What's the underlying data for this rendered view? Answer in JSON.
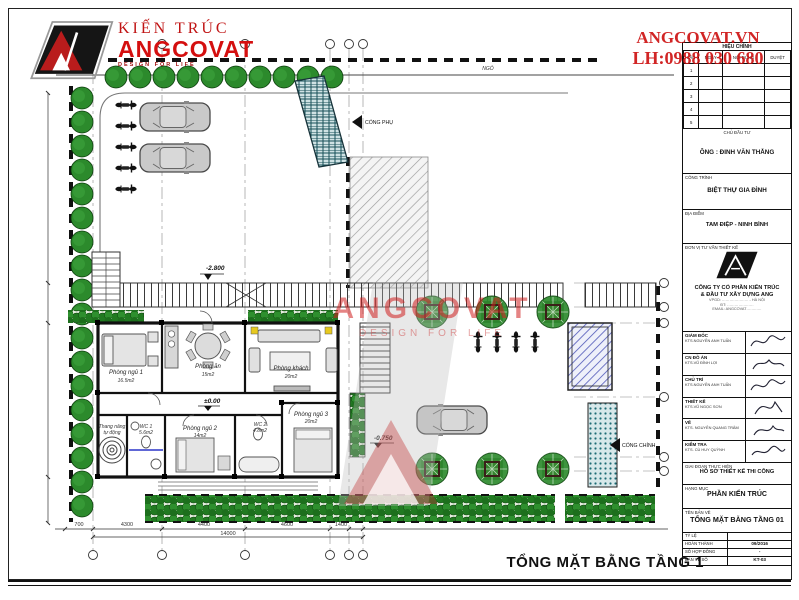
{
  "branding": {
    "logo_top_text": "KIẾN TRÚC",
    "logo_name": "ANGCOVAT",
    "logo_tagline": "DESIGN FOR LIFE",
    "site": "ANGCOVAT.VN",
    "phone": "LH:0988 030 680",
    "watermark_name": "ANGCOVAT",
    "watermark_tagline": "DESIGN FOR LIFE",
    "accent_red": "#d40f0f"
  },
  "revision": {
    "title": "HIỆU CHỈNH",
    "columns": [
      "LẦN",
      "NGÀY",
      "NỘI DUNG",
      "DUYỆT"
    ],
    "row_numbers": [
      "1",
      "2",
      "3",
      "4",
      "5"
    ]
  },
  "title_block": {
    "investor": {
      "label": "CHỦ ĐẦU TƯ",
      "value": "ÔNG : ĐINH VĂN THẮNG"
    },
    "project": {
      "label": "CÔNG TRÌNH",
      "value": "BIỆT THỰ GIA ĐÌNH"
    },
    "location": {
      "label": "ĐỊA ĐIỂM",
      "value": "TAM ĐIỆP - NINH BÌNH"
    },
    "consultant": {
      "label": "ĐƠN VỊ TƯ VẤN THIẾT KẾ",
      "company_line1": "CÔNG TY CỔ PHẦN KIẾN TRÚC",
      "company_line2": "& ĐẦU TƯ XÂY DỰNG ANG",
      "contact1": "VPGD: ………………… - HÀ NỘI",
      "contact2": "ĐT: …………………",
      "contact3": "EMAIL: ANGCOVAT…………"
    },
    "signatures": [
      {
        "role": "GIÁM ĐỐC",
        "name": "KTS.NGUYỄN ANH TUẤN"
      },
      {
        "role": "CN ĐỒ ÁN",
        "name": "KTS.VŨ ĐÌNH LỢI"
      },
      {
        "role": "CHỦ TRÌ",
        "name": "KTS.NGUYỄN ANH TUẤN"
      },
      {
        "role": "THIẾT KẾ",
        "name": "KTS.VŨ NGỌC SƠN"
      },
      {
        "role": "VẼ",
        "name": "KTS. NGUYỄN QUANG TRÂM"
      },
      {
        "role": "KIỂM TRA",
        "name": "KTS. CÙ HUY QUỲNH"
      }
    ],
    "stage": {
      "label": "GIAI ĐOẠN THỰC HIỆN",
      "value": "HỒ SƠ THIẾT KẾ THI CÔNG"
    },
    "category": {
      "label": "HẠNG MỤC",
      "value": "PHẦN KIẾN TRÚC"
    },
    "sheet": {
      "label": "TÊN BẢN VẼ",
      "value": "TỔNG MẶT BẰNG TẦNG 01"
    },
    "meta": [
      {
        "label": "TỶ LỆ",
        "value": ""
      },
      {
        "label": "HOÀN THÀNH",
        "value": "09/2016"
      },
      {
        "label": "SỐ HỢP ĐỒNG",
        "value": "-"
      },
      {
        "label": "BẢN VẼ SỐ",
        "value": "KT-03"
      }
    ]
  },
  "plan": {
    "drawing_title": "TỔNG MẶT BẰNG TẦNG 1",
    "road": "NGỎ",
    "side_gate": "CỔNG PHỤ",
    "main_gate": "CỔNG CHÍNH",
    "levels": {
      "upper_yard": "-2.800",
      "house": "±0.00",
      "lower_yard": "-0.750"
    },
    "rooms": [
      {
        "name": "Phòng ngủ 1",
        "area": "16.5m2"
      },
      {
        "name": "Phòng ăn",
        "area": "15m2"
      },
      {
        "name": "Phòng khách",
        "area": "20m2"
      },
      {
        "name": "Thang nâng",
        "area": "tự động"
      },
      {
        "name": "WC 1",
        "area": "5.6m2"
      },
      {
        "name": "Phòng ngủ 2",
        "area": "14m2"
      },
      {
        "name": "WC 2",
        "area": "4.8m2"
      },
      {
        "name": "Phòng ngủ 3",
        "area": "20m2"
      }
    ],
    "dims": {
      "d0": "700",
      "d1": "4300",
      "d2": "4400",
      "d3": "4600",
      "d4": "1400",
      "total": "14000"
    }
  }
}
